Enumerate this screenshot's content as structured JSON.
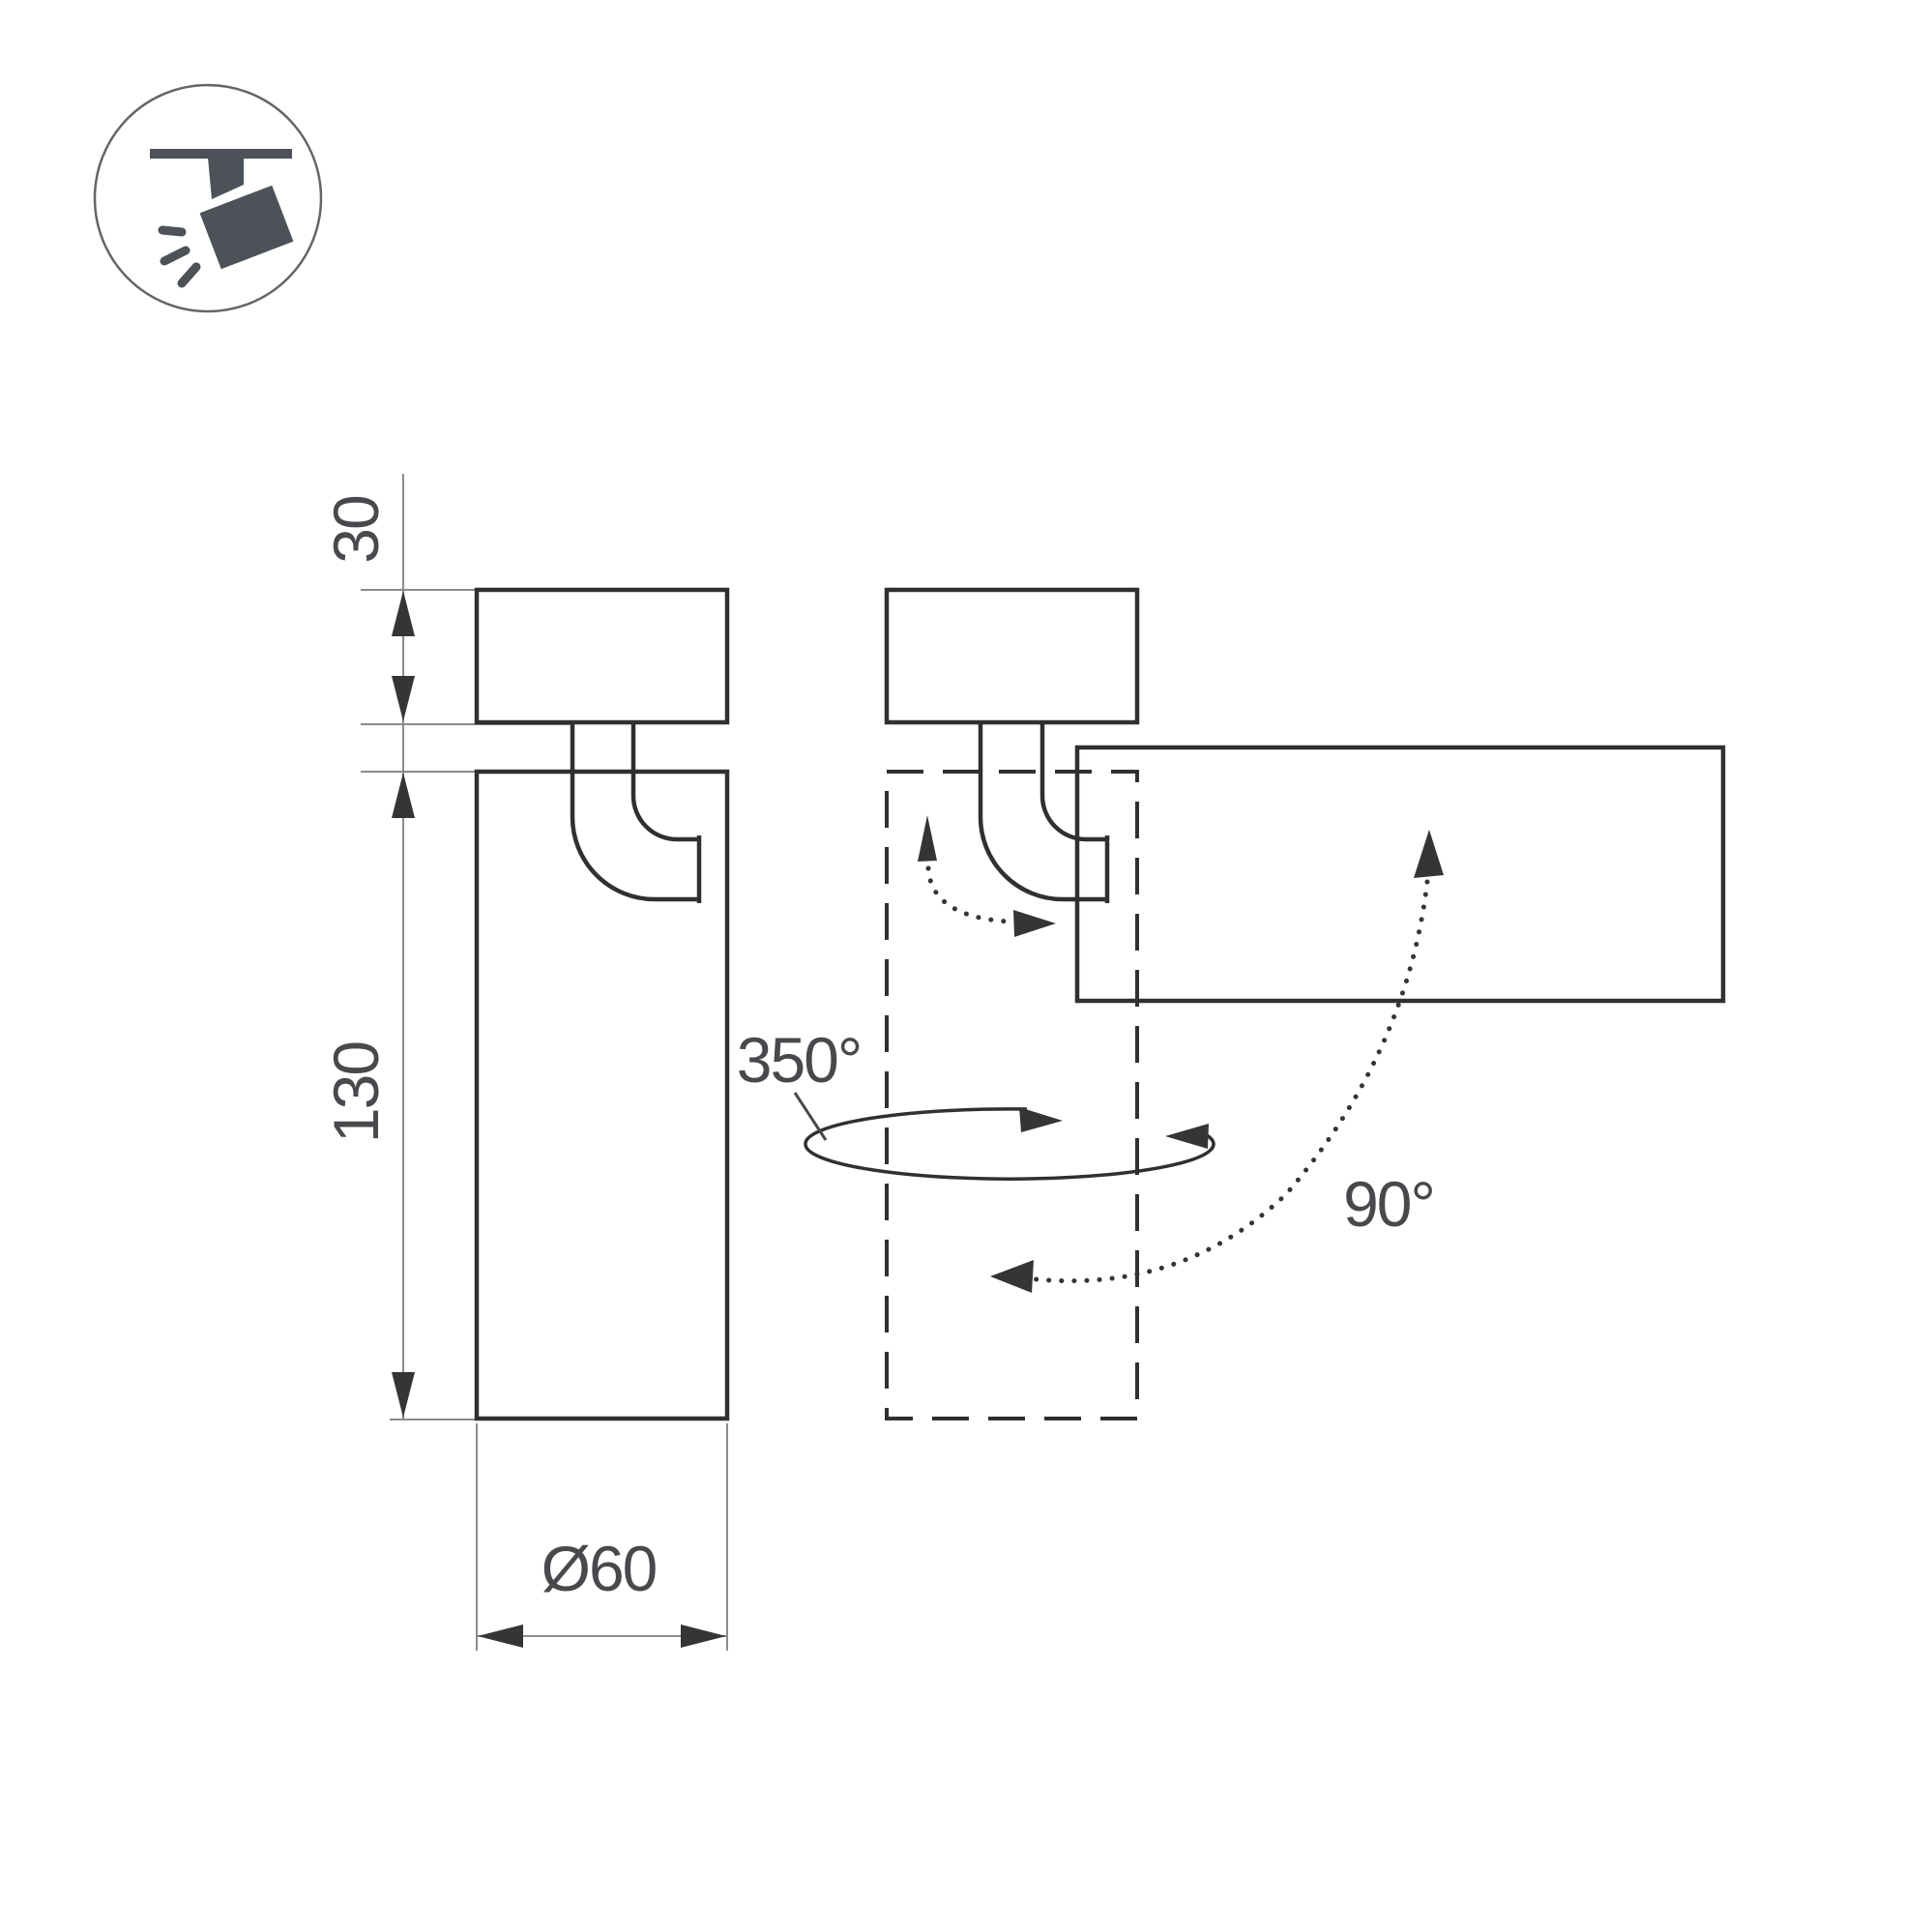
{
  "drawing": {
    "labels": {
      "base_height": "30",
      "body_height": "130",
      "diameter": "Ø60",
      "pan_angle": "350°",
      "tilt_angle": "90°"
    },
    "colors": {
      "line": "#2e3032",
      "thin": "#8a8c8e",
      "text": "#47494c",
      "arrow": "#333537",
      "icon": "#4c5258",
      "icon-ring": "#61666a",
      "background": "#ffffff"
    },
    "icon": "ceiling-track-spotlight-icon",
    "views": {
      "left": "spotlight-front-view-with-dimensions",
      "right": "spotlight-rotation-view"
    }
  }
}
